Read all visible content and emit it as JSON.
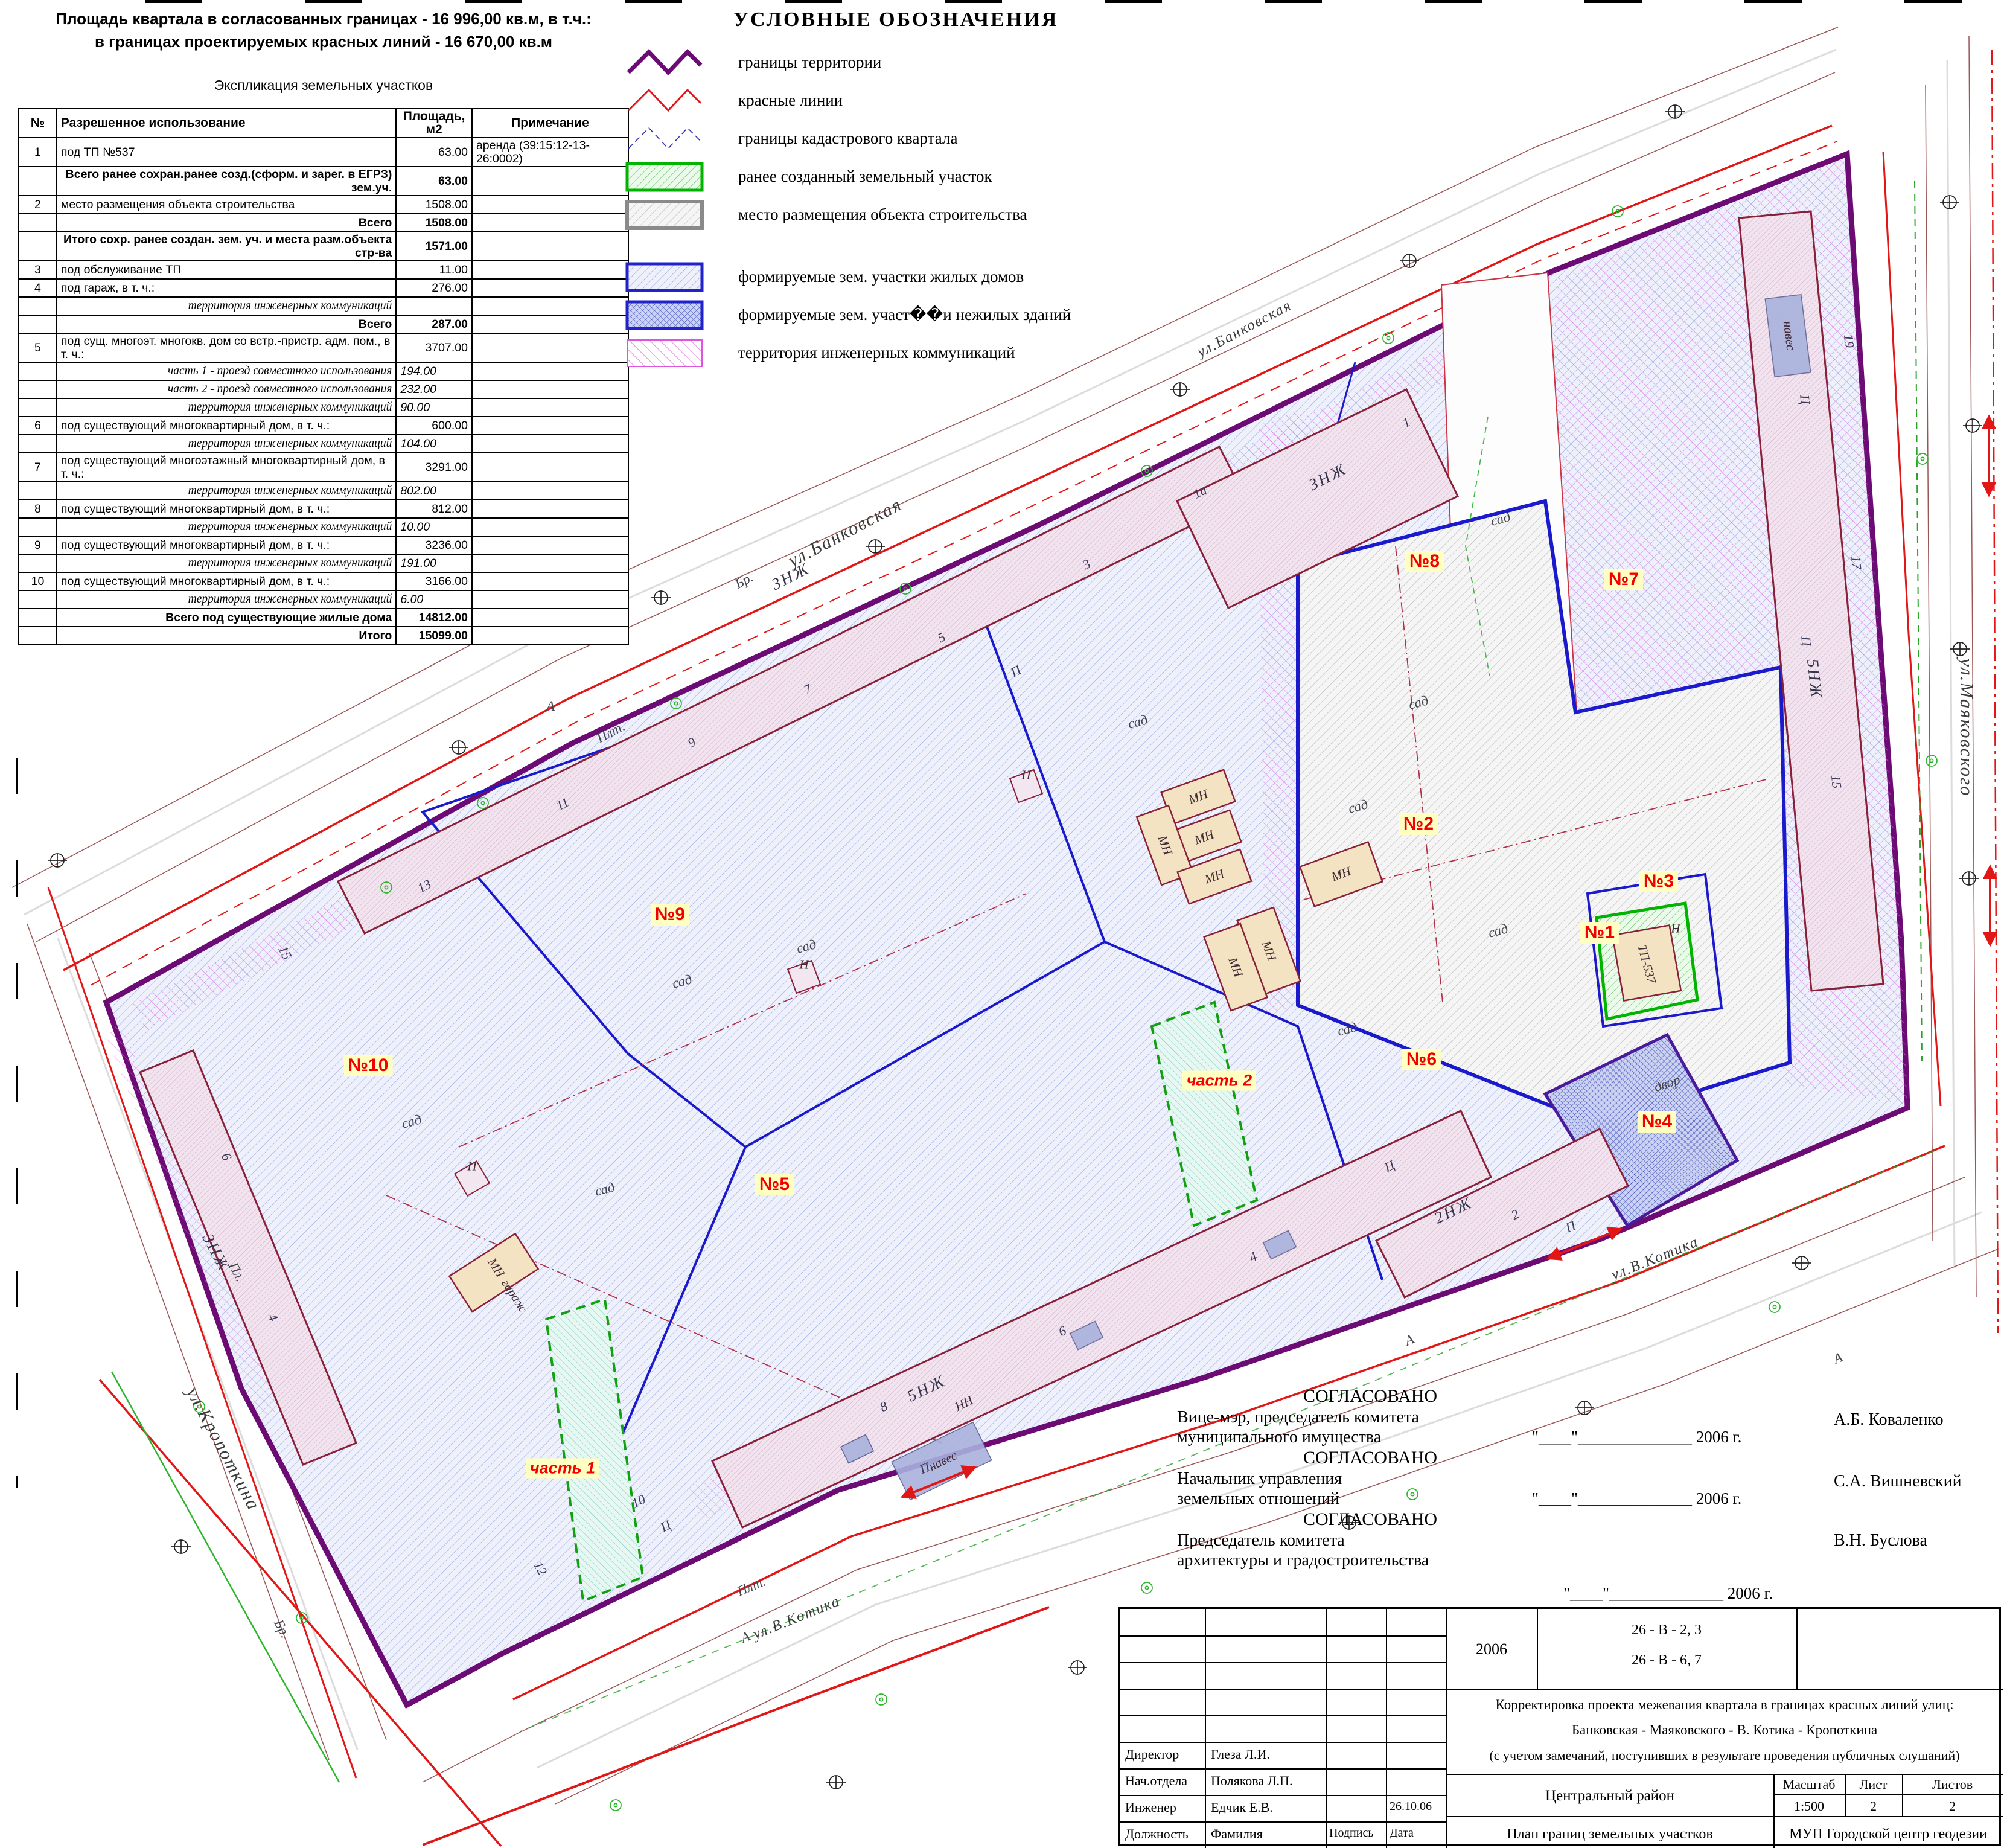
{
  "header": {
    "line1": "Площадь квартала в согласованных границах - 16 996,00 кв.м, в т.ч.:",
    "line2": "в границах проектируемых красных линий - 16 670,00 кв.м",
    "table_title": "Экспликация земельных участков"
  },
  "table": {
    "col_num": "№",
    "col_use": "Разрешенное использование",
    "col_area1": "Площадь,",
    "col_area2": "м2",
    "col_note": "Примечание",
    "rows": [
      {
        "n": "1",
        "u": "под ТП №537",
        "a": "63.00",
        "no": "аренда  (39:15:12-13-26:0002)",
        "c": ""
      },
      {
        "n": "",
        "u": "Всего ранее сохран.ранее созд.(сформ. и зарег. в ЕГРЗ) зем.уч.",
        "a": "63.00",
        "no": "",
        "c": "b"
      },
      {
        "n": "2",
        "u": "место размещения объекта строительства",
        "a": "1508.00",
        "no": "",
        "c": ""
      },
      {
        "n": "",
        "u": "Всего",
        "a": "1508.00",
        "no": "",
        "c": "b"
      },
      {
        "n": "",
        "u": "Итого сохр. ранее создан. зем. уч. и места разм.объекта стр-ва",
        "a": "1571.00",
        "no": "",
        "c": "b"
      },
      {
        "n": "3",
        "u": "под обслуживание ТП",
        "a": "11.00",
        "no": "",
        "c": ""
      },
      {
        "n": "4",
        "u": "под гараж, в т. ч.:",
        "a": "276.00",
        "no": "",
        "c": ""
      },
      {
        "n": "",
        "u": "территория инженерных коммуникаций",
        "a": "",
        "no": "",
        "c": "i"
      },
      {
        "n": "",
        "u": "Всего",
        "a": "287.00",
        "no": "",
        "c": "b"
      },
      {
        "n": "5",
        "u": "под сущ. многоэт. многокв. дом со встр.-пристр. адм. пом., в т. ч.:",
        "a": "3707.00",
        "no": "",
        "c": ""
      },
      {
        "n": "",
        "u": "часть 1 - проезд совместного использования",
        "a": "194.00",
        "no": "",
        "c": "i"
      },
      {
        "n": "",
        "u": "часть 2 - проезд совместного использования",
        "a": "232.00",
        "no": "",
        "c": "i"
      },
      {
        "n": "",
        "u": "территория инженерных коммуникаций",
        "a": "90.00",
        "no": "",
        "c": "i"
      },
      {
        "n": "6",
        "u": "под существующий многоквартирный дом, в т. ч.:",
        "a": "600.00",
        "no": "",
        "c": ""
      },
      {
        "n": "",
        "u": "территория инженерных коммуникаций",
        "a": "104.00",
        "no": "",
        "c": "i"
      },
      {
        "n": "7",
        "u": "под существующий многоэтажный многоквартирный дом, в т. ч.:",
        "a": "3291.00",
        "no": "",
        "c": ""
      },
      {
        "n": "",
        "u": "территория инженерных коммуникаций",
        "a": "802.00",
        "no": "",
        "c": "i"
      },
      {
        "n": "8",
        "u": "под существующий многоквартирный дом, в т. ч.:",
        "a": "812.00",
        "no": "",
        "c": ""
      },
      {
        "n": "",
        "u": "территория инженерных коммуникаций",
        "a": "10.00",
        "no": "",
        "c": "i"
      },
      {
        "n": "9",
        "u": "под существующий многоквартирный дом, в т. ч.:",
        "a": "3236.00",
        "no": "",
        "c": ""
      },
      {
        "n": "",
        "u": "территория инженерных коммуникаций",
        "a": "191.00",
        "no": "",
        "c": "i"
      },
      {
        "n": "10",
        "u": "под существующий многоквартирный дом, в т. ч.:",
        "a": "3166.00",
        "no": "",
        "c": ""
      },
      {
        "n": "",
        "u": "территория инженерных коммуникаций",
        "a": "6.00",
        "no": "",
        "c": "i"
      },
      {
        "n": "",
        "u": "Всего под существующие жилые дома",
        "a": "14812.00",
        "no": "",
        "c": "b"
      },
      {
        "n": "",
        "u": "Итого",
        "a": "15099.00",
        "no": "",
        "c": "b"
      }
    ]
  },
  "legend": {
    "title": "УСЛОВНЫЕ ОБОЗНАЧЕНИЯ",
    "items": [
      {
        "label": "границы территории"
      },
      {
        "label": "красные линии"
      },
      {
        "label": "границы кадастрового квартала"
      },
      {
        "label": "ранее созданный земельный участок"
      },
      {
        "label": "место размещения объекта строительства"
      },
      {
        "label": "формируемые зем. участки жилых домов"
      },
      {
        "label": "формируемые зем. участ��и нежилых зданий"
      },
      {
        "label": "территория инженерных коммуникаций"
      }
    ]
  },
  "map": {
    "streets": {
      "bankovskaya": "ул.Банковская",
      "mayakovskogo": "ул.Маяковского",
      "kotika": "ул.В.Котика",
      "kropotkina": "ул.Кропоткина"
    },
    "parcels": {
      "p1": "№1",
      "p2": "№2",
      "p3": "№3",
      "p4": "№4",
      "p5": "№5",
      "p6": "№6",
      "p7": "№7",
      "p8": "№8",
      "p9": "№9",
      "p10": "№10",
      "part1": "часть 1",
      "part2": "часть 2"
    },
    "buildings": {
      "znzh": "ЗНЖ",
      "nzh5": "5НЖ",
      "nzh2": "2НЖ",
      "mn": "МН",
      "n": "Н",
      "nn": "НН",
      "naves": "навес",
      "garazh": "гараж",
      "tp": "ТП-537",
      "dvor": "двор"
    },
    "marks": {
      "sad": "сад",
      "br": "Бр.",
      "plt": "Плт.",
      "pl": "Пл.",
      "a": "А",
      "p": "П",
      "ts": "Ц"
    },
    "houses": {
      "h1a": "1а",
      "h1": "1",
      "h2": "2",
      "h3": "3",
      "h4": "4",
      "h5": "5",
      "h6": "6",
      "h7": "7",
      "h8": "8",
      "h9": "9",
      "h10": "10",
      "h11": "11",
      "h12": "12",
      "h13": "13",
      "h15": "15",
      "h17": "17",
      "h19": "19"
    }
  },
  "approvals": {
    "approved": "СОГЛАСОВАНО",
    "dateline": "\"____\"______________ 2006 г.",
    "blocks": [
      {
        "role1": "Вице-мэр, председатель комитета",
        "role2": "муниципального имущества",
        "name": "А.Б. Коваленко"
      },
      {
        "role1": "Начальник управления",
        "role2": "земельных отношений",
        "name": "С.А. Вишневский"
      },
      {
        "role1": "Председатель комитета",
        "role2": "архитектуры и градостроительства",
        "name": "В.Н. Буслова"
      }
    ]
  },
  "title_block": {
    "year": "2006",
    "ref1": "26 - В - 2, 3",
    "ref2": "26 - В - 6, 7",
    "title1": "Корректировка проекта межевания квартала в границах красных линий улиц:",
    "title2": "Банковская - Маяковского - В. Котика - Кропоткина",
    "title3": "(с учетом замечаний, поступивших в результате проведения публичных слушаний)",
    "district": "Центральный район",
    "scale_label": "Масштаб",
    "scale": "1:500",
    "sheet_label": "Лист",
    "sheet": "2",
    "sheets_label": "Листов",
    "sheets": "2",
    "doc_name": "План границ земельных участков",
    "org": "МУП Городской центр геодезии",
    "rows": [
      {
        "role": "Директор",
        "name": "Глеза Л.И.",
        "date": ""
      },
      {
        "role": "Нач.отдела",
        "name": "Полякова Л.П.",
        "date": ""
      },
      {
        "role": "Инженер",
        "name": "Едчик Е.В.",
        "date": "26.10.06"
      }
    ],
    "footer": {
      "role": "Должность",
      "name": "Фамилия",
      "sign": "Подпись",
      "date": "Дата"
    }
  }
}
